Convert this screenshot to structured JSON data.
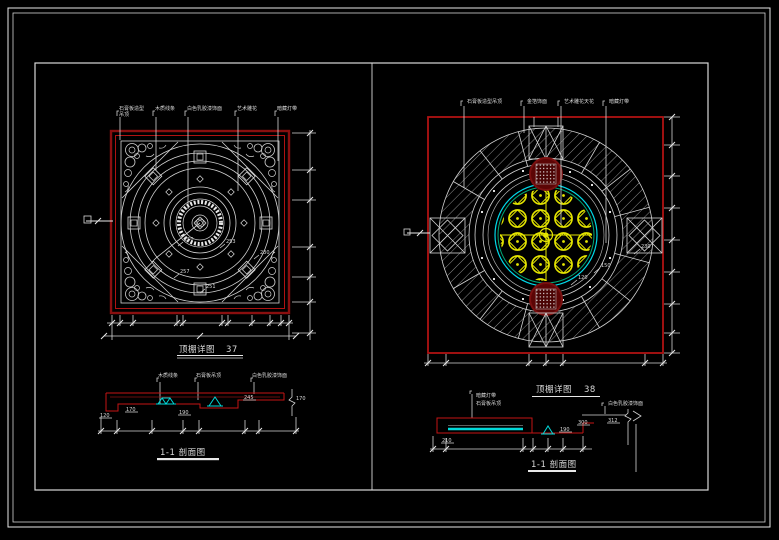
{
  "drawing": {
    "type": "ceiling-detail-cad-sheet",
    "background": "#000000",
    "colors": {
      "frame_white": "#d9d9d9",
      "border_red": "#b01212",
      "dark_red_medallion": "#5c0505",
      "accent_cyan": "#00d8e8",
      "accent_yellow": "#e6e600",
      "accent_green": "#00a878",
      "text": "#d8d8d8"
    }
  },
  "left_plan": {
    "title": "顶棚详图",
    "number": "37",
    "callouts": {
      "c1": "石膏板造型",
      "c1b": "吊顶",
      "c2": "木质线条",
      "c3": "白色乳胶漆饰面",
      "c4": "艺术雕花",
      "c5": "暗藏灯带"
    },
    "dims": {
      "d1": "250",
      "d2": "253",
      "d3": "230",
      "d4": "257",
      "d5": "251"
    }
  },
  "left_section": {
    "title": "1-1 剖面图",
    "callouts": {
      "c1": "木质线条",
      "c2": "石膏板吊顶",
      "c3": "白色乳胶漆饰面"
    },
    "dims": {
      "d1": "120",
      "d2": "170",
      "d3": "190",
      "d4": "245",
      "d5": "170"
    }
  },
  "right_plan": {
    "title": "顶棚详图",
    "number": "38",
    "callouts": {
      "c1": "石膏板造型吊顶",
      "c2": "金箔饰面",
      "c3": "艺术雕花天花",
      "c4": "暗藏灯带"
    },
    "dims": {
      "d1": "230",
      "d2": "150",
      "d3": "120"
    }
  },
  "right_section": {
    "title": "1-1 剖面图",
    "callouts": {
      "c1": "暗藏灯带",
      "c2": "石膏板吊顶",
      "c3": "白色乳胶漆饰面"
    },
    "dims": {
      "d1": "210",
      "d2": "190",
      "d3": "300",
      "d4": "312"
    }
  }
}
